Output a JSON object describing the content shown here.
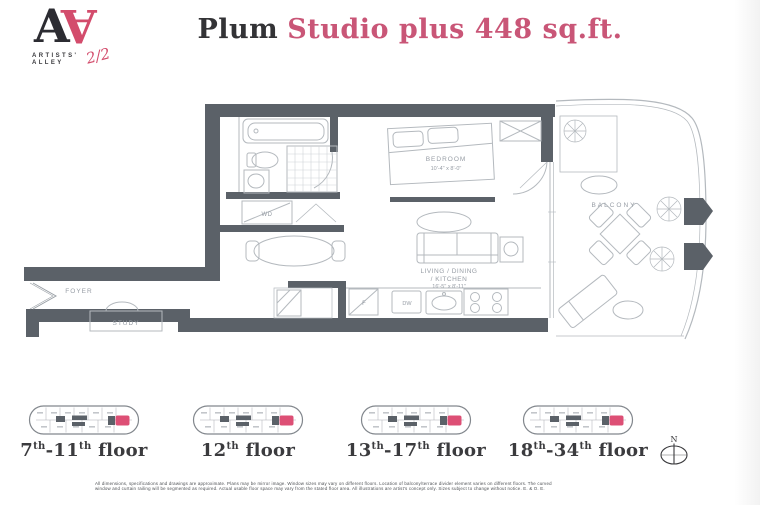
{
  "brand": {
    "monogram_left": "A",
    "monogram_right": "A",
    "name_line1": "ARTISTS'",
    "name_line2": "ALLEY",
    "handwritten_note": "2/2"
  },
  "title": {
    "plan_name": "Plum",
    "description": "Studio plus 448 sq.ft."
  },
  "plan_labels": {
    "foyer": "FOYER",
    "study": "STUDY",
    "washer_dryer": "WD",
    "bedroom": "BEDROOM",
    "bedroom_dim": "10'-4\" x 8'-0\"",
    "living_line1": "LIVING / DINING",
    "living_line2": "/ KITCHEN",
    "living_dim": "16'-5\" x 8'-11\"",
    "balcony": "BALCONY",
    "fridge": "F",
    "dishwasher": "DW"
  },
  "keyplans": [
    {
      "label": "7th-11th floor"
    },
    {
      "label": "12th floor"
    },
    {
      "label": "13th-17th floor"
    },
    {
      "label": "18th-34th floor"
    }
  ],
  "compass": {
    "north": "N"
  },
  "disclaimer": {
    "line1": "All dimensions, specifications and drawings are approximate. Plans may be mirror image. Window sizes may vary on different floors. Location of balcony/terrace divider element varies on different floors. The curved",
    "line2": "window and curtain railing will be segmented as required. Actual usable floor space may vary from the stated floor area. All illustrations are artist's concept only. Sizes subject to change without notice. E. & O. E."
  },
  "colors": {
    "wall": "#5b6168",
    "accent_pink": "#dd4f75",
    "title_pink": "#c95677",
    "logo_black": "#2c2c32"
  }
}
